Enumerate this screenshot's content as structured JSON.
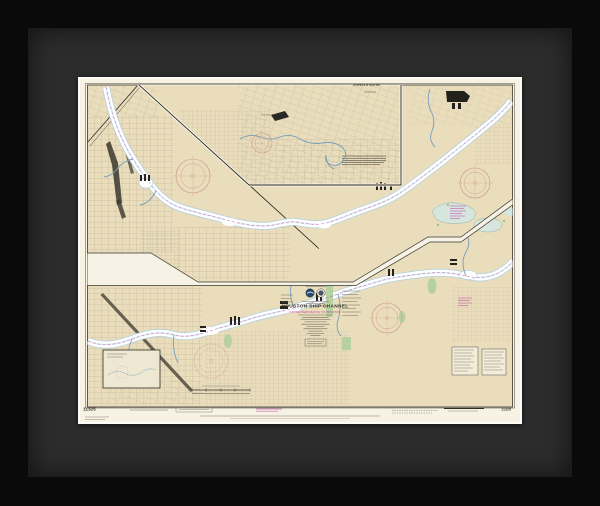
{
  "artwork": {
    "chart": {
      "title": "HOUSTON SHIP CHANNEL",
      "subtitle": "CARPENTERS BAYOU TO HOUSTON",
      "inset_title": "BUFFALO BAYOU",
      "placename_houston": "HOUSTON",
      "number_bottom_left": "11325",
      "number_bottom_right": "11325"
    },
    "colors": {
      "frame": "#0a0a0a",
      "mat": "#2c2c2c",
      "paper": "#f7f2e4",
      "land": "#e9ddbc",
      "water_edge": "#b9d2dc",
      "compass_rose": "#cf9186",
      "magenta": "#bb4aa2",
      "marsh_green": "#b7d0a1",
      "ink": "#35322a"
    }
  }
}
